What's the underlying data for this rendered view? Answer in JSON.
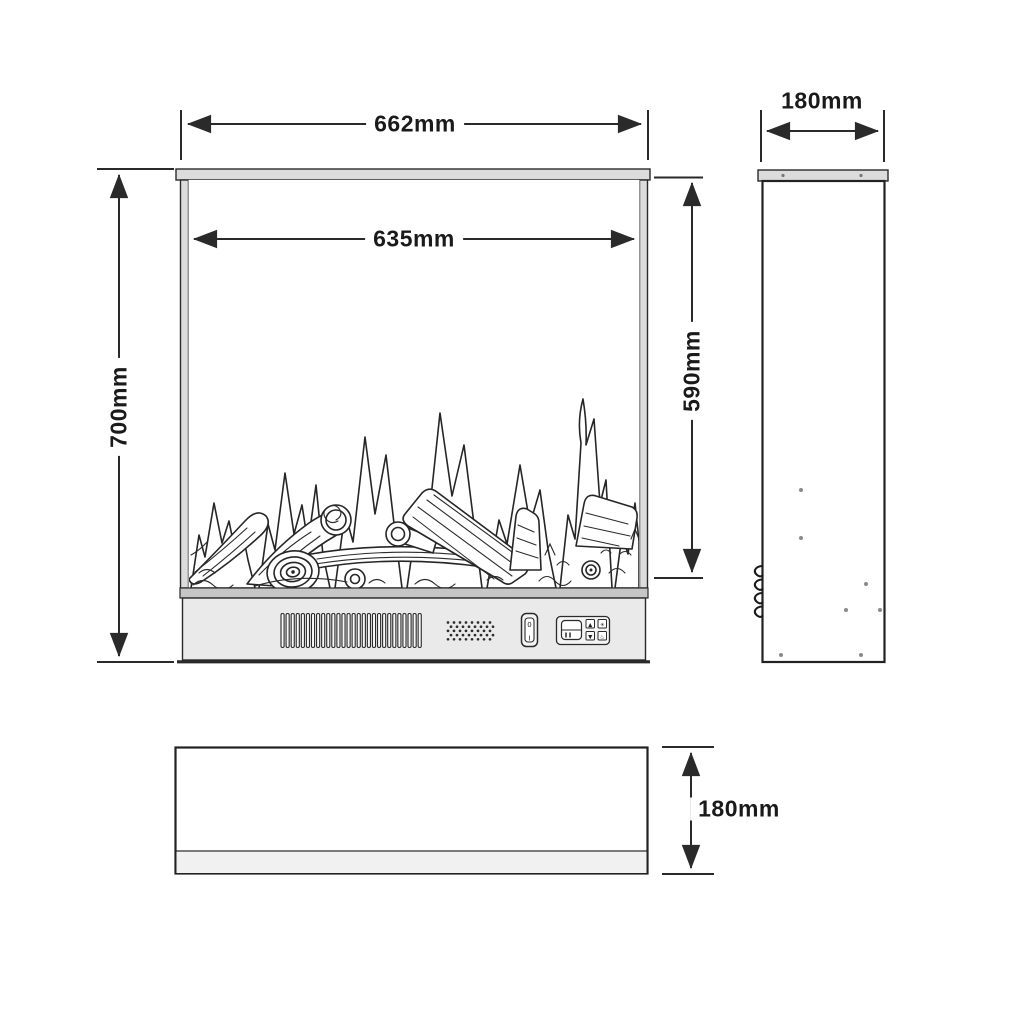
{
  "dimensions": {
    "front_overall_width": "662mm",
    "front_opening_width": "635mm",
    "front_overall_height": "700mm",
    "front_opening_height": "590mm",
    "side_depth": "180mm",
    "bottom_depth": "180mm"
  },
  "front_view": {
    "power_switch": {
      "off_mark": "0",
      "on_mark": "I"
    },
    "control_buttons": [
      {
        "name": "flame-up-button",
        "glyph": "▲"
      },
      {
        "name": "fan-button",
        "glyph": "✳"
      },
      {
        "name": "flame-down-button",
        "glyph": "▼"
      },
      {
        "name": "heat-button",
        "glyph": "♨"
      }
    ]
  },
  "colors": {
    "line": "#2a2a2a",
    "frame_fill": "#dcdcdc",
    "separator_fill": "#c6c6c6",
    "panel_fill": "#eaeaea",
    "background": "#ffffff"
  }
}
